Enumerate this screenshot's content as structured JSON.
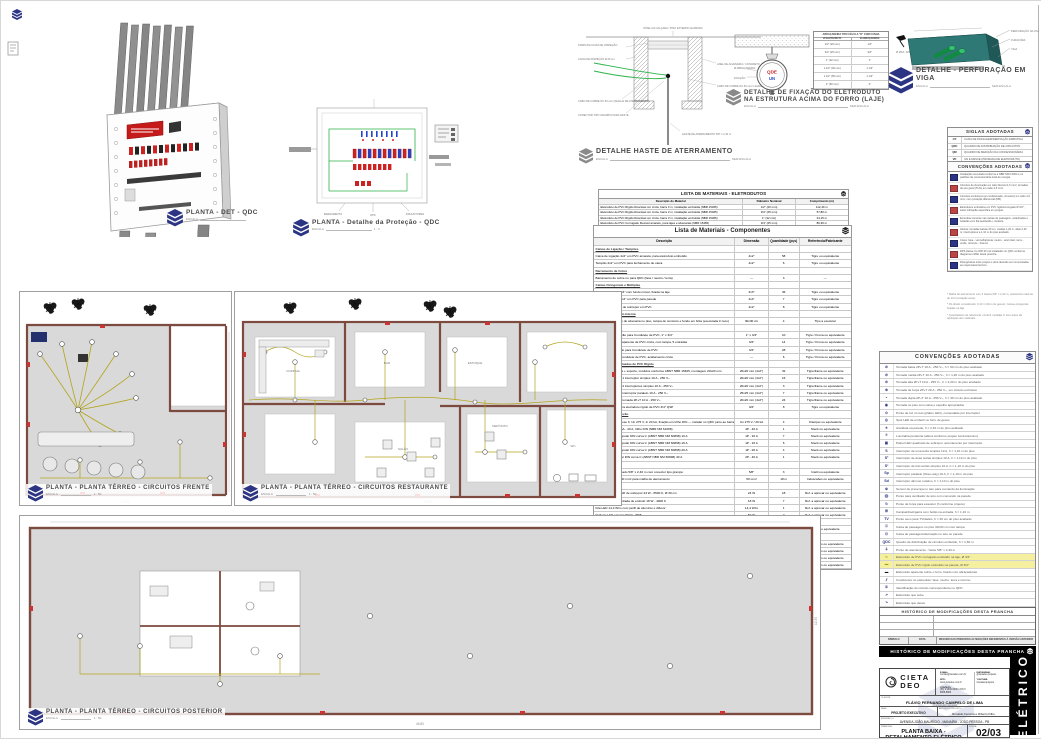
{
  "colors": {
    "navy": "#2b3583",
    "wall": "#7d4a3f",
    "floor": "#d9d9d9",
    "circuit": "#b3a41c",
    "green": "#2db34a",
    "teal": "#2e7876",
    "red": "#cc2222",
    "banner_bg": "#000000"
  },
  "details": {
    "qdc3d": {
      "title": "PLANTA - DET - QDC",
      "scale_label": "ESCALA",
      "scale_value": ""
    },
    "protecao": {
      "title": "PLANTA - Detalhe da Proteção - QDC",
      "scale_label": "ESCALA",
      "scale_value": "1 : 3",
      "annotations": [
        "BARRAMENTO",
        "DPS",
        "DISJUNTORES"
      ]
    },
    "haste": {
      "title": "DETALHE HASTE DE ATERRAMENTO",
      "scale_label": "ESCALA",
      "scale_value": "SEM ESCALA",
      "labels": {
        "top": "NÍVEL DA CALÇADA / PISO EXTERNO ACABADO",
        "l1": "TAMPA DA CAIXA DE INSPEÇÃO",
        "l2": "CAIXA DE INSPEÇÃO Ø 25 cm",
        "l3": "CABO DE COBRE NU 50 mm² (MALHA DE ATERRAMENTO)",
        "l4": "CONECTOR TIPO GRAMPO PARA HASTE",
        "r1": "ANEL DE ALVENARIA / CONCRETO",
        "r2": "CABO DE COBRE NU 50 mm² LIGADO AO BEP",
        "rod": "HASTE DE ATERRAMENTO 5/8\" x 2,40 m"
      }
    },
    "fixacao": {
      "title1": "DETALHE DE FIXAÇÃO DO ELETRODUTO",
      "title2": "NA ESTRUTURA ACIMA DO FORRO (LAJE)",
      "scale_label": "ESCALA",
      "scale_value": "SEM ESCALA",
      "left1": "Ø ABRAÇADEIRA",
      "left2": "FIXAÇÃO",
      "circle1": "QDE",
      "circle2": "UN",
      "table": {
        "h1": "ABRAÇADEIRA TIPO CÉLULA \"D\" COM CUNHA",
        "c1": "Ø ELETRODUTO",
        "c2": "Ø ABRAÇADEIRA",
        "rows": [
          [
            "1/2\" (20 mm)",
            "1/2\""
          ],
          [
            "3/4\" (25 mm)",
            "3/4\""
          ],
          [
            "1\" (32 mm)",
            "1\""
          ],
          [
            "1 1/4\" (40 mm)",
            "1 1/4\""
          ],
          [
            "1 1/2\" (50 mm)",
            "1 1/2\""
          ],
          [
            "2\" (60 mm)",
            "2\""
          ]
        ]
      }
    },
    "viga": {
      "title": "DETALHE - PERFURAÇÃO EM VIGA",
      "scale_label": "ESCALA",
      "scale_value": "SEM ESCALA",
      "labels": [
        "PERFURAÇÃO NA VIGA",
        "FURAÇÕES",
        "VIGA"
      ],
      "left_label": "Ø MÁX. D/3"
    }
  },
  "lists": {
    "eletrodutos": {
      "title": "LISTA DE MATERIAIS - ELETRODUTOS",
      "cols": [
        "Descrição do Material",
        "Diâmetro Nominal",
        "Comprimento (m)"
      ],
      "rows": [
        [
          "Eletroduto de PVC Rígido Roscável cor cinza, barra 3 m, instalação embutida (NBR 15465)",
          "1/2\" (20 mm)",
          "112,40 m"
        ],
        [
          "Eletroduto de PVC Rígido Roscável cor cinza, barra 3 m, instalação embutida (NBR 15465)",
          "3/4\" (25 mm)",
          "57,80 m"
        ],
        [
          "Eletroduto de PVC Rígido Roscável cor cinza, barra 3 m, instalação embutida (NBR 15465)",
          "1\" (32 mm)",
          "24,15 m"
        ],
        [
          "Eletroduto de PVC Corrugado Flexível amarelo, para lajes e alvenarias (NBR 15465)",
          "3/4\" (25 mm)",
          "86,30 m"
        ]
      ]
    },
    "componentes": {
      "title": "Lista de Materiais - Componentes",
      "cols": [
        "Descrição",
        "Dimensão",
        "Quantidade (pçs)",
        "Referência/Fabricante"
      ],
      "rows": [
        {
          "d": "Caixas de Ligação / Tampões",
          "s": "",
          "q": "",
          "r": "",
          "_class": "grp"
        },
        {
          "d": "Caixa de Ligação 4x2\" em PVC amarela, para eletroduto embutido",
          "s": "4x2\"",
          "q": "58",
          "r": "Tigre ou equivalente"
        },
        {
          "d": "Tampão 4x2\" em PVC para fechamento de caixa",
          "s": "4x2\"",
          "q": "6",
          "r": "Tigre ou equivalente"
        },
        {
          "d": "Barramento de Cobre",
          "s": "",
          "q": "",
          "r": "",
          "_class": "grp"
        },
        {
          "d": "Barramento de cobre nu para QDC (fase / neutro / terra)",
          "s": "—",
          "q": "3",
          "r": "—"
        },
        {
          "d": "Caixas Octogonais e Múltiplas",
          "s": "",
          "q": "",
          "r": "",
          "_class": "grp"
        },
        {
          "d": "Caixa Octogonal 3x3\" com fundo móvel, fixada na laje",
          "s": "3x3\"",
          "q": "36",
          "r": "Tigre ou equivalente"
        },
        {
          "d": "Caixa de Ligação 4x4\" em PVC para parede",
          "s": "4x4\"",
          "q": "7",
          "r": "Tigre ou equivalente"
        },
        {
          "d": "Caixa Múltipla 4x2\" de sobrepor em PVC",
          "s": "4x2\"",
          "q": "8",
          "r": "Tigre ou equivalente"
        },
        {
          "d": "Caixa de Passagem Interna",
          "s": "",
          "q": "",
          "r": "",
          "_class": "grp"
        },
        {
          "d": "Caixa de passagem de alvenaria no piso, tampa de concreto e fundo em brita (executada in loco)",
          "s": "30x30 cm",
          "q": "4",
          "r": "Tipo a executar"
        },
        {
          "d": "Condutores (PVC)",
          "s": "",
          "q": "",
          "r": "",
          "_class": "grp"
        },
        {
          "d": "Adaptador de redução para Condulete de PVC, 1\" x 3/4\"",
          "s": "1\" x 3/4\"",
          "q": "10",
          "r": "Tigre / Krona ou equivalente"
        },
        {
          "d": "Condulete múltiplo aparente de PVC cinza, com tampa, 5 entradas",
          "s": "3/4\"",
          "q": "14",
          "r": "Tigre / Krona ou equivalente"
        },
        {
          "d": "Adaptador flangeado para Condulete de PVC",
          "s": "3/4\"",
          "q": "28",
          "r": "Tigre / Krona ou equivalente"
        },
        {
          "d": "Tampa cega para Condulete de PVC, acabamento cinza",
          "s": "—",
          "q": "6",
          "r": "Tigre / Krona ou equivalente"
        },
        {
          "d": "Interruptores e Tomadas de PVC Rígido",
          "s": "",
          "q": "",
          "r": "",
          "_class": "grp"
        },
        {
          "d": "Conjunto 4x2\" placa + suporte, módulos conforme ABNT NBR 15465, montagem 20x20 mm",
          "s": "20x20 mm (4x2\")",
          "q": "32",
          "r": "Tigre/Fame ou equivalente"
        },
        {
          "d": "Conjunto 4x2\" com 1 interruptor simples 10 A - 250 V~",
          "s": "20x20 mm (4x2\")",
          "q": "16",
          "r": "Tigre/Fame ou equivalente"
        },
        {
          "d": "Conjunto 4x2\" com 2 interruptores simples 10 A - 250 V~",
          "s": "20x20 mm (4x2\")",
          "q": "3",
          "r": "Tigre/Fame ou equivalente"
        },
        {
          "d": "Conjunto 4x2\" com interruptor paralelo 10 A - 250 V~",
          "s": "25x25 mm (4x2\")",
          "q": "7",
          "r": "Tigre/Fame ou equivalente"
        },
        {
          "d": "Conjunto 4x2\" com tomada 2P+T 10 A - 250 V~",
          "s": "20x20 mm (4x2\")",
          "q": "24",
          "r": "Tigre/Fame ou equivalente"
        },
        {
          "d": "Luva / curva 90° para eletroduto rígido de PVC 3/4\" QSP",
          "s": "3/4\"",
          "q": "8",
          "r": "Tigre ou equivalente"
        },
        {
          "d": "Disjuntores / Proteção",
          "s": "",
          "q": "",
          "r": "",
          "_class": "grp"
        },
        {
          "d": "DPS monopolar classe II, Un 275 V, In 20 kA, fixação em trilho DIN — instalar no QDC junto ao barramento, conforme diagrama unifilar",
          "s": "Un 275 V / 20 kA",
          "q": "4",
          "r": "Clamper ou equivalente"
        },
        {
          "d": "IDR tetrapolar 30 mA - 40 A, trilho DIN (NBR NM 61008)",
          "s": "4P - 40 A",
          "q": "1",
          "r": "Steck ou equivalente"
        },
        {
          "d": "Mini disjuntor monopolar DIN curva C (ABNT NBR NM 60898) 10 A",
          "s": "1P - 10 A",
          "q": "7",
          "r": "Steck ou equivalente"
        },
        {
          "d": "Mini disjuntor monopolar DIN curva C (ABNT NBR NM 60898) 16 A",
          "s": "1P - 16 A",
          "q": "6",
          "r": "Steck ou equivalente"
        },
        {
          "d": "Mini disjuntor monopolar DIN curva C (ABNT NBR NM 60898) 20 A",
          "s": "1P - 20 A",
          "q": "4",
          "r": "Steck ou equivalente"
        },
        {
          "d": "Mini disjuntor bipolar DIN curva C (ABNT NBR NM 60898) 40 A",
          "s": "2P - 40 A",
          "q": "1",
          "r": "Steck ou equivalente"
        },
        {
          "d": "Aterramento",
          "s": "",
          "q": "",
          "r": "",
          "_class": "grp"
        },
        {
          "d": "Haste de aço cobreado 5/8\" x 2,40 m com conector tipo grampo",
          "s": "5/8\"",
          "q": "3",
          "r": "Intelli ou equivalente"
        },
        {
          "d": "Cabo de cobre nu 50 mm² para malha de aterramento",
          "s": "50 mm²",
          "q": "18 m",
          "r": "Induscabos ou equivalente"
        },
        {
          "d": "Iluminação",
          "s": "",
          "q": "",
          "r": "",
          "_class": "grp"
        },
        {
          "d": "Luminária plafon LED de sobrepor 24 W - 6500 K, Ø 30 cm",
          "s": "24 W",
          "q": "18",
          "r": "Ref. a aprovar ou equivalente"
        },
        {
          "d": "Luminária LED quadrada de embutir 18 W - 4000 K",
          "s": "18 W",
          "q": "7",
          "r": "Ref. a aprovar ou equivalente"
        },
        {
          "d": "Fita LED 14,4 W/m com perfil de alumínio e difusor",
          "s": "14,4 W/m",
          "q": "1",
          "r": "Ref. a aprovar ou equivalente"
        },
        {
          "d": "Refletor LED externo 50 W - IP65",
          "s": "50 W",
          "q": "2",
          "r": "Ref. a aprovar ou equivalente"
        },
        {
          "d": "Quadro de Distribuição",
          "s": "",
          "q": "",
          "r": "",
          "_class": "grp"
        },
        {
          "d": "Quadro de distribuição de embutir p/ 24 disjuntores DIN, com porta e barramentos (QDC)",
          "s": "24 DIN",
          "q": "1",
          "r": "Steck ou equivalente"
        },
        {
          "d": "Cabos Flexíveis 750 V (NBR NM 247-3)",
          "s": "",
          "q": "",
          "r": "",
          "_class": "grp"
        },
        {
          "d": "Cabo flexível 1,5 mm² - circuitos de iluminação",
          "s": "1,5 mm²",
          "q": "420 m",
          "r": "Induscabos ou equivalente"
        },
        {
          "d": "Cabo flexível 2,5 mm² - tomadas de uso geral",
          "s": "2,5 mm²",
          "q": "685 m",
          "r": "Induscabos ou equivalente"
        },
        {
          "d": "Cabo flexível 4,0 mm² - circuitos exclusivos",
          "s": "4,0 mm²",
          "q": "96 m",
          "r": "Induscabos ou equivalente"
        },
        {
          "d": "Cabo flexível 10,0 mm² - alimentador geral do QDC",
          "s": "10,0 mm²",
          "q": "32 m",
          "r": "Induscabos ou equivalente"
        }
      ]
    }
  },
  "right_col": {
    "siglas": {
      "title": "SIGLAS ADOTADAS",
      "rows": [
        [
          "CP",
          "CAIXA DE PASSAGEM/DERIVAÇÃO EMBUTIDA"
        ],
        [
          "QDC",
          "QUADRO DE DISTRIBUIÇÃO DE CIRCUITOS"
        ],
        [
          "QM",
          "QUADRO DE MEDIÇÃO DA CONCESSIONÁRIA"
        ],
        [
          "VD",
          "VAI E DESCE (PRUMADA DE ELETRODUTO)"
        ]
      ]
    },
    "notas": {
      "title": "CONVENÇÕES ADOTADAS",
      "rows": [
        {
          "d": "Instalação executada conforme a NBR 5410:2004 e os padrões da concessionária local de energia."
        },
        {
          "d": "Circuitos de iluminação em cabo flexível 1,5 mm²; tomadas de uso geral (TUG) em cabo 2,5 mm²."
        },
        {
          "d": "Circuitos exclusivos (ar-condicionado, chuveiro) em cabo 4,0 mm², com proteção diferencial (DR)."
        },
        {
          "d": "Eletrodutos embutidos em PVC rígido/corrugado Ø 3/4\", salvo indicação específica em projeto."
        },
        {
          "d": "Emendas somente nas caixas de passagem, estanhadas e isoladas com fita autofusão + isolante."
        },
        {
          "d": "Alturas: tomadas baixas 30 cm, médias 1,20 m, altas 2,20 m; interruptores a 1,10 m do piso acabado."
        },
        {
          "d": "Cores: fase - vermelha/preta; neutro - azul claro; terra - verde; retornos - branca."
        },
        {
          "d": "DPS classe II e IDR 30 mA instalados no QDC conforme diagrama unifilar desta prancha."
        },
        {
          "d": "Divergências entre projeto e obra deverão ser comunicadas ao responsável técnico."
        }
      ]
    },
    "obs": [
      "* Malha de aterramento com 3 hastes 5/8\" x 2,40 m, resistência máxima de 10 Ω (estação seca).",
      "* Pé-direito considerado: 3,10 m (forro de gesso). Caixas octogonais fixadas na laje.",
      "* Quantitativos de referência: conferir medidas in loco antes da aquisição dos materiais."
    ],
    "legend": {
      "title": "CONVENÇÕES ADOTADAS",
      "rows": [
        {
          "sym": "⊘",
          "d": "Tomada baixa 2P+T 10 A - 250 V~, h = 30 cm do piso acabado"
        },
        {
          "sym": "⊘",
          "d": "Tomada média 2P+T 10 A - 250 V~, h = 1,20 m do piso acabado"
        },
        {
          "sym": "⊘",
          "d": "Tomada alta 2P+T 10 A - 250 V~, h = 2,20 m do piso acabado"
        },
        {
          "sym": "⊕",
          "d": "Tomada de força 2P+T 20 A - 250 V~, em circuito exclusivo"
        },
        {
          "sym": "◒",
          "d": "Tomada dupla 2P+T 10 A - 250 V~, h = 30 cm do piso acabado"
        },
        {
          "sym": "◉",
          "d": "Tomada no piso com caixa e espelho apropriados"
        },
        {
          "sym": "⊙",
          "d": "Ponto de luz no teto (plafon LED), comandado por interruptor"
        },
        {
          "sym": "◎",
          "d": "Spot LED de embutir no forro de gesso"
        },
        {
          "sym": "✶",
          "d": "Arandela na parede, h = 2,10 m do piso acabado"
        },
        {
          "sym": "⌾",
          "d": "Luminária pendente (altura conforme projeto luminotécnico)"
        },
        {
          "sym": "▣",
          "d": "Painel LED quadrado de sobrepor, acionamento por interruptor"
        },
        {
          "sym": "S",
          "d": "Interruptor de uma tecla simples 10 A, h = 1,10 m do piso"
        },
        {
          "sym": "S²",
          "d": "Interruptor de duas teclas simples 10 A, h = 1,10 m do piso"
        },
        {
          "sym": "S³",
          "d": "Interruptor de três teclas simples 10 A, h = 1,10 m do piso"
        },
        {
          "sym": "Sp",
          "d": "Interruptor paralelo (three-way) 10 A, h = 1,10 m do piso"
        },
        {
          "sym": "Sd",
          "d": "Interruptor dimmer rotativo, h = 1,10 m do piso"
        },
        {
          "sym": "⊛",
          "d": "Sensor de presença no teto para comando da iluminação"
        },
        {
          "sym": "⨂",
          "d": "Ponto para ventilador de teto com comando na parede"
        },
        {
          "sym": "⍉",
          "d": "Ponto de força para exaustor (h conforme projeto)"
        },
        {
          "sym": "⊞",
          "d": "Campainha/cigarra com botão na entrada, h = 1,10 m"
        },
        {
          "sym": "TV",
          "d": "Ponto seco para TV/dados, h = 30 cm do piso acabado"
        },
        {
          "sym": "⌻",
          "d": "Caixa de passagem no piso 30x30 cm com tampa"
        },
        {
          "sym": "⌼",
          "d": "Caixa de passagem/derivação no teto ou parede"
        },
        {
          "sym": "QDC",
          "d": "Quadro de distribuição de circuitos embutido, h = 1,60 m"
        },
        {
          "sym": "⏚",
          "d": "Ponto de aterramento - haste 5/8\" x 2,40 m"
        },
        {
          "sym": "∿",
          "d": "Eletroduto de PVC corrugado embutido na laje, Ø 3/4\"",
          "_class": "hly"
        },
        {
          "sym": "▬",
          "d": "Eletroduto de PVC rígido embutido na parede, Ø 3/4\"",
          "_class": "hly"
        },
        {
          "sym": "▬",
          "d": "Eletroduto aparente sobre o forro, fixado com abraçadeiras",
          "_class": "symk"
        },
        {
          "sym": "⫽",
          "d": "Condutores no eletroduto: fase, neutro, terra e retorno"
        },
        {
          "sym": "①",
          "d": "Identificação do circuito correspondente no QDC"
        },
        {
          "sym": "↗",
          "d": "Eletroduto que sobe"
        },
        {
          "sym": "↘",
          "d": "Eletroduto que desce"
        },
        {
          "sym": "⤳",
          "d": "Circuito que apenas passa (sem derivação no ponto)"
        },
        {
          "sym": "⊟",
          "d": "Ponto de equipotencialização (BEP)"
        },
        {
          "sym": "▲",
          "d": "Ponto de força p/ chuveiro elétrico, circuito exclusivo com DR"
        },
        {
          "sym": "▩",
          "d": "Destaque de revisão/observação nesta prancha",
          "_class": "symr"
        }
      ]
    },
    "historico": {
      "title": "HISTÓRICO DE MODIFICAÇÕES DESTA PRANCHA",
      "cols": [
        "SÍMBOLO",
        "DATA",
        "RESUMO DAS PRINCIPAIS ALTERAÇÕES REFERENTES À VERSÃO ANTERIOR"
      ]
    }
  },
  "titleblock": {
    "bar_title": "HISTÓRICO DE MODIFICAÇÕES DESTA PRANCHA",
    "brand1": "CIETA",
    "brand2": "DEO",
    "contact": {
      "email_label": "E-MAIL:",
      "email": "contato@cietadeo.com.br",
      "site_label": "SITE:",
      "site": "www.cietadeo.com.br",
      "phone_label": "CONTATO:",
      "phone": "(83) 9 9999-9999 / (83) 9 8888-8888",
      "insta_label": "INSTAGRAM:",
      "insta": "@cietadeo.projetos",
      "yt_label": "YOUTUBE:",
      "yt": "/cietadeoprojetos"
    },
    "client_label": "CLIENTE:",
    "client": "FLÁVIO FERNANDO CAMPELO DE LIMA",
    "client_sub": "PROPRIETÁRIO DA OBRA",
    "fase_label": "FASE:",
    "fase": "PROJETO EXECUTIVO",
    "autor_label": "AUTOR DO PROJETO:",
    "autor": "Ronaldo Ferreira e Ribeiro Filho",
    "endereco_label": "ENDEREÇO:",
    "endereco": "AVENIDA JOÃO MAURÍCIO - MANAÍRA - JOÃO PESSOA - PB",
    "prancha_label": "PRANCHA:",
    "prancha": "PLANTA BAIXA - DETALHAMENTO ELÉTRICO",
    "folha_label": "FOLHA:",
    "folha": "02/03",
    "escala_label": "ESCALA:",
    "escala": "INDICADA",
    "desenhista_label": "DESENHISTA:",
    "desenhista": "WAGNER OLIVEIRA",
    "uso_label": "USO:",
    "uso": "COMERCIAL",
    "banner": "ELÉTRICO"
  },
  "plans": {
    "frente": {
      "title": "PLANTA - PLANTA TÉRREO - CIRCUITOS FRENTE",
      "scale_label": "ESCALA",
      "scale": "1 : 50",
      "dim": "14.25"
    },
    "restaurante": {
      "title": "PLANTA - PLANTA TÉRREO - CIRCUITOS RESTAURANTE",
      "scale_label": "ESCALA",
      "scale": "1 : 50",
      "dim": "27.90",
      "rooms": [
        "COZINHA",
        "BAR",
        "ESTOQUE",
        "SALÃO",
        "WC",
        "DEPÓSITO"
      ]
    },
    "posterior": {
      "title": "PLANTA - PLANTA TÉRREO - CIRCUITOS POSTERIOR",
      "scale_label": "ESCALA",
      "scale": "1 : 50",
      "dim": "46.80",
      "dim2": "12.35"
    }
  }
}
